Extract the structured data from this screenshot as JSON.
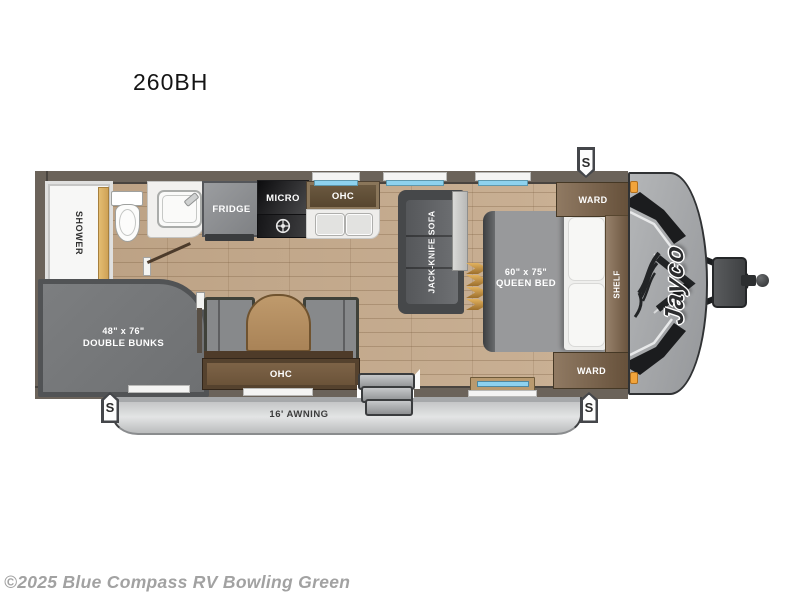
{
  "title": "260BH",
  "copyright": "©2025 Blue Compass RV Bowling Green",
  "brand_logo": "Jayco",
  "speaker_label": "S",
  "labels": {
    "shower": "SHOWER",
    "fridge": "FRIDGE",
    "micro": "MICRO",
    "kitchen_ohc": "OHC",
    "sofa": "JACK-KNIFE SOFA",
    "ward_top": "WARD",
    "ward_bottom": "WARD",
    "shelf": "SHELF",
    "queen_bed_size": "60\" x 75\"",
    "queen_bed_name": "QUEEN BED",
    "bunks_size": "48\" x 76\"",
    "bunks_name": "DOUBLE BUNKS",
    "dinette_ohc": "OHC",
    "awning": "16' AWNING"
  },
  "colors": {
    "floor": "#c5a98a",
    "wall": "#6b635a",
    "wood": "#7c6247",
    "gray_furniture": "#87898b",
    "awning": "#d4d6d7",
    "window": "#8ed2ee",
    "accent_orange": "#f2a43b"
  }
}
